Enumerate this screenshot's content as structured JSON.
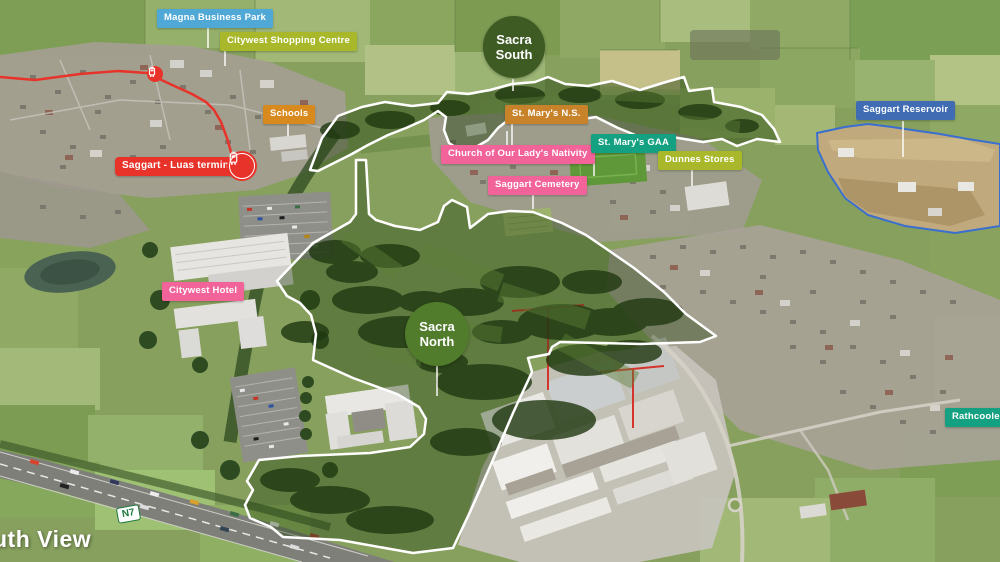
{
  "scene": "Sacra North and Sacra South aerial masterplan map, Saggart",
  "sites": {
    "south": {
      "name": "Sacra South",
      "line1": "Sacra",
      "line2": "South",
      "circle_color": "#3E5B24"
    },
    "north": {
      "name": "Sacra North",
      "line1": "Sacra",
      "line2": "North",
      "circle_color": "#507C2C"
    }
  },
  "labels": {
    "magna": {
      "text": "Magna Business Park",
      "color": "#4FA8D5"
    },
    "shopping": {
      "text": "Citywest Shopping Centre",
      "color": "#A9B82A"
    },
    "schools": {
      "text": "Schools",
      "color": "#D98A1E"
    },
    "luas": {
      "text": "Saggart - Luas terminal",
      "color": "#E8332A"
    },
    "ns": {
      "text": "St. Mary's N.S.",
      "color": "#C8832A"
    },
    "church": {
      "text": "Church of Our Lady's Nativity",
      "color": "#F2639A"
    },
    "gaa": {
      "text": "St. Mary's GAA",
      "color": "#14A181"
    },
    "dunnes": {
      "text": "Dunnes Stores",
      "color": "#A9B82A"
    },
    "reservoir": {
      "text": "Saggart Reservoir",
      "color": "#3F6CB3"
    },
    "cemetery": {
      "text": "Saggart Cemetery",
      "color": "#F2639A"
    },
    "hotel": {
      "text": "Citywest Hotel",
      "color": "#F2639A"
    },
    "rathcoole": {
      "text": "Rathcoole",
      "color": "#14A181"
    }
  },
  "road_badge": {
    "text": "N7",
    "color": "#1d7a3c"
  },
  "caption": {
    "text": "uth View"
  },
  "map_features": {
    "luas_line_color": "#E8332A",
    "site_outline_color": "#FFFFFF",
    "reservoir_outline_color": "#3A6FD0"
  }
}
